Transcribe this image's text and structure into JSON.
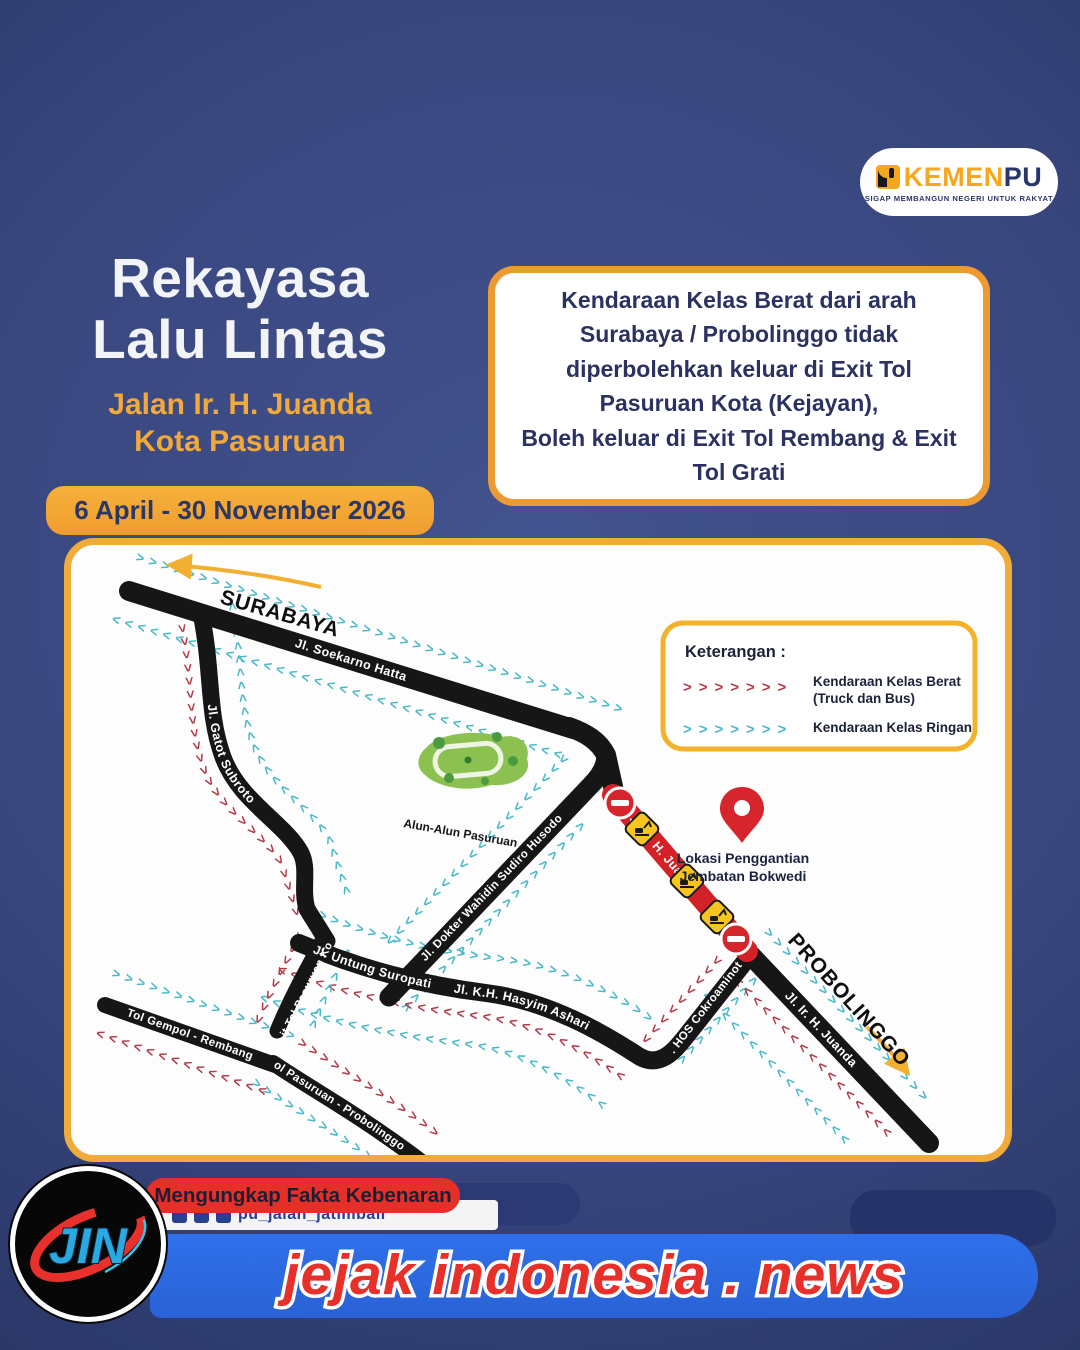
{
  "header": {
    "logo": {
      "kemen": "KEMEN",
      "pu": "PU",
      "tagline": "SIGAP MEMBANGUN NEGERI UNTUK RAKYAT"
    },
    "title_line1": "Rekayasa",
    "title_line2": "Lalu Lintas",
    "subtitle_line1": "Jalan Ir. H. Juanda",
    "subtitle_line2": "Kota Pasuruan",
    "date_range": "6 April - 30 November 2026",
    "notice_lines": [
      "Kendaraan Kelas Berat dari arah",
      "Surabaya / Probolinggo tidak",
      "diperbolehkan keluar di Exit Tol",
      "Pasuruan Kota (Kejayan),",
      "Boleh keluar di Exit Tol Rembang & Exit",
      "Tol Grati"
    ]
  },
  "map": {
    "city_from": "SURABAYA",
    "city_to": "PROBOLINGGO",
    "roads": {
      "soekarno": "Jl. Soekarno Hatta",
      "gatot": "Jl. Gatot Subroto",
      "wahidin": "Jl. Dokter Wahidin Sudiro Husodo",
      "untung": "Jl. Untung Suropati",
      "hasyim": "Jl. K.H. Hasyim Ashari",
      "hos": "Jl. HOS Cokroaminoto",
      "juanda_closed": "Jl. Ir. H. Juanda",
      "juanda_south": "Jl. Ir. H. Juanda",
      "tol_gempol": "Tol Gempol - Rembang",
      "exit_tol": "Exit Tol Pasuruan Kota",
      "tol_pasuruan": "Tol Pasuruan - Probolinggo"
    },
    "park_label": "Alun-Alun Pasuruan",
    "pin_label_line1": "Lokasi Penggantian",
    "pin_label_line2": "Jembatan Bokwedi",
    "legend": {
      "title": "Keterangan :",
      "items": [
        {
          "glyph": ">>>>>>>",
          "color": "#b23b48",
          "label_line1": "Kendaraan Kelas Berat",
          "label_line2": "(Truck dan Bus)"
        },
        {
          "glyph": ">>>>>>>",
          "color": "#49b9c7",
          "label_line1": "Kendaraan Kelas Ringan",
          "label_line2": ""
        }
      ]
    },
    "chevron_glyphs": {
      "r": ">",
      "l": "<"
    },
    "colors": {
      "heavy": "#b23b48",
      "light": "#49b9c7",
      "road": "#161616",
      "closed": "#d42027"
    }
  },
  "footer": {
    "logo_text": "JIN",
    "tagline": "Mengungkap Fakta Kebenaran",
    "social_handle": "pu_jalan_jatimbali",
    "brand": "jejak indonesia . news"
  }
}
